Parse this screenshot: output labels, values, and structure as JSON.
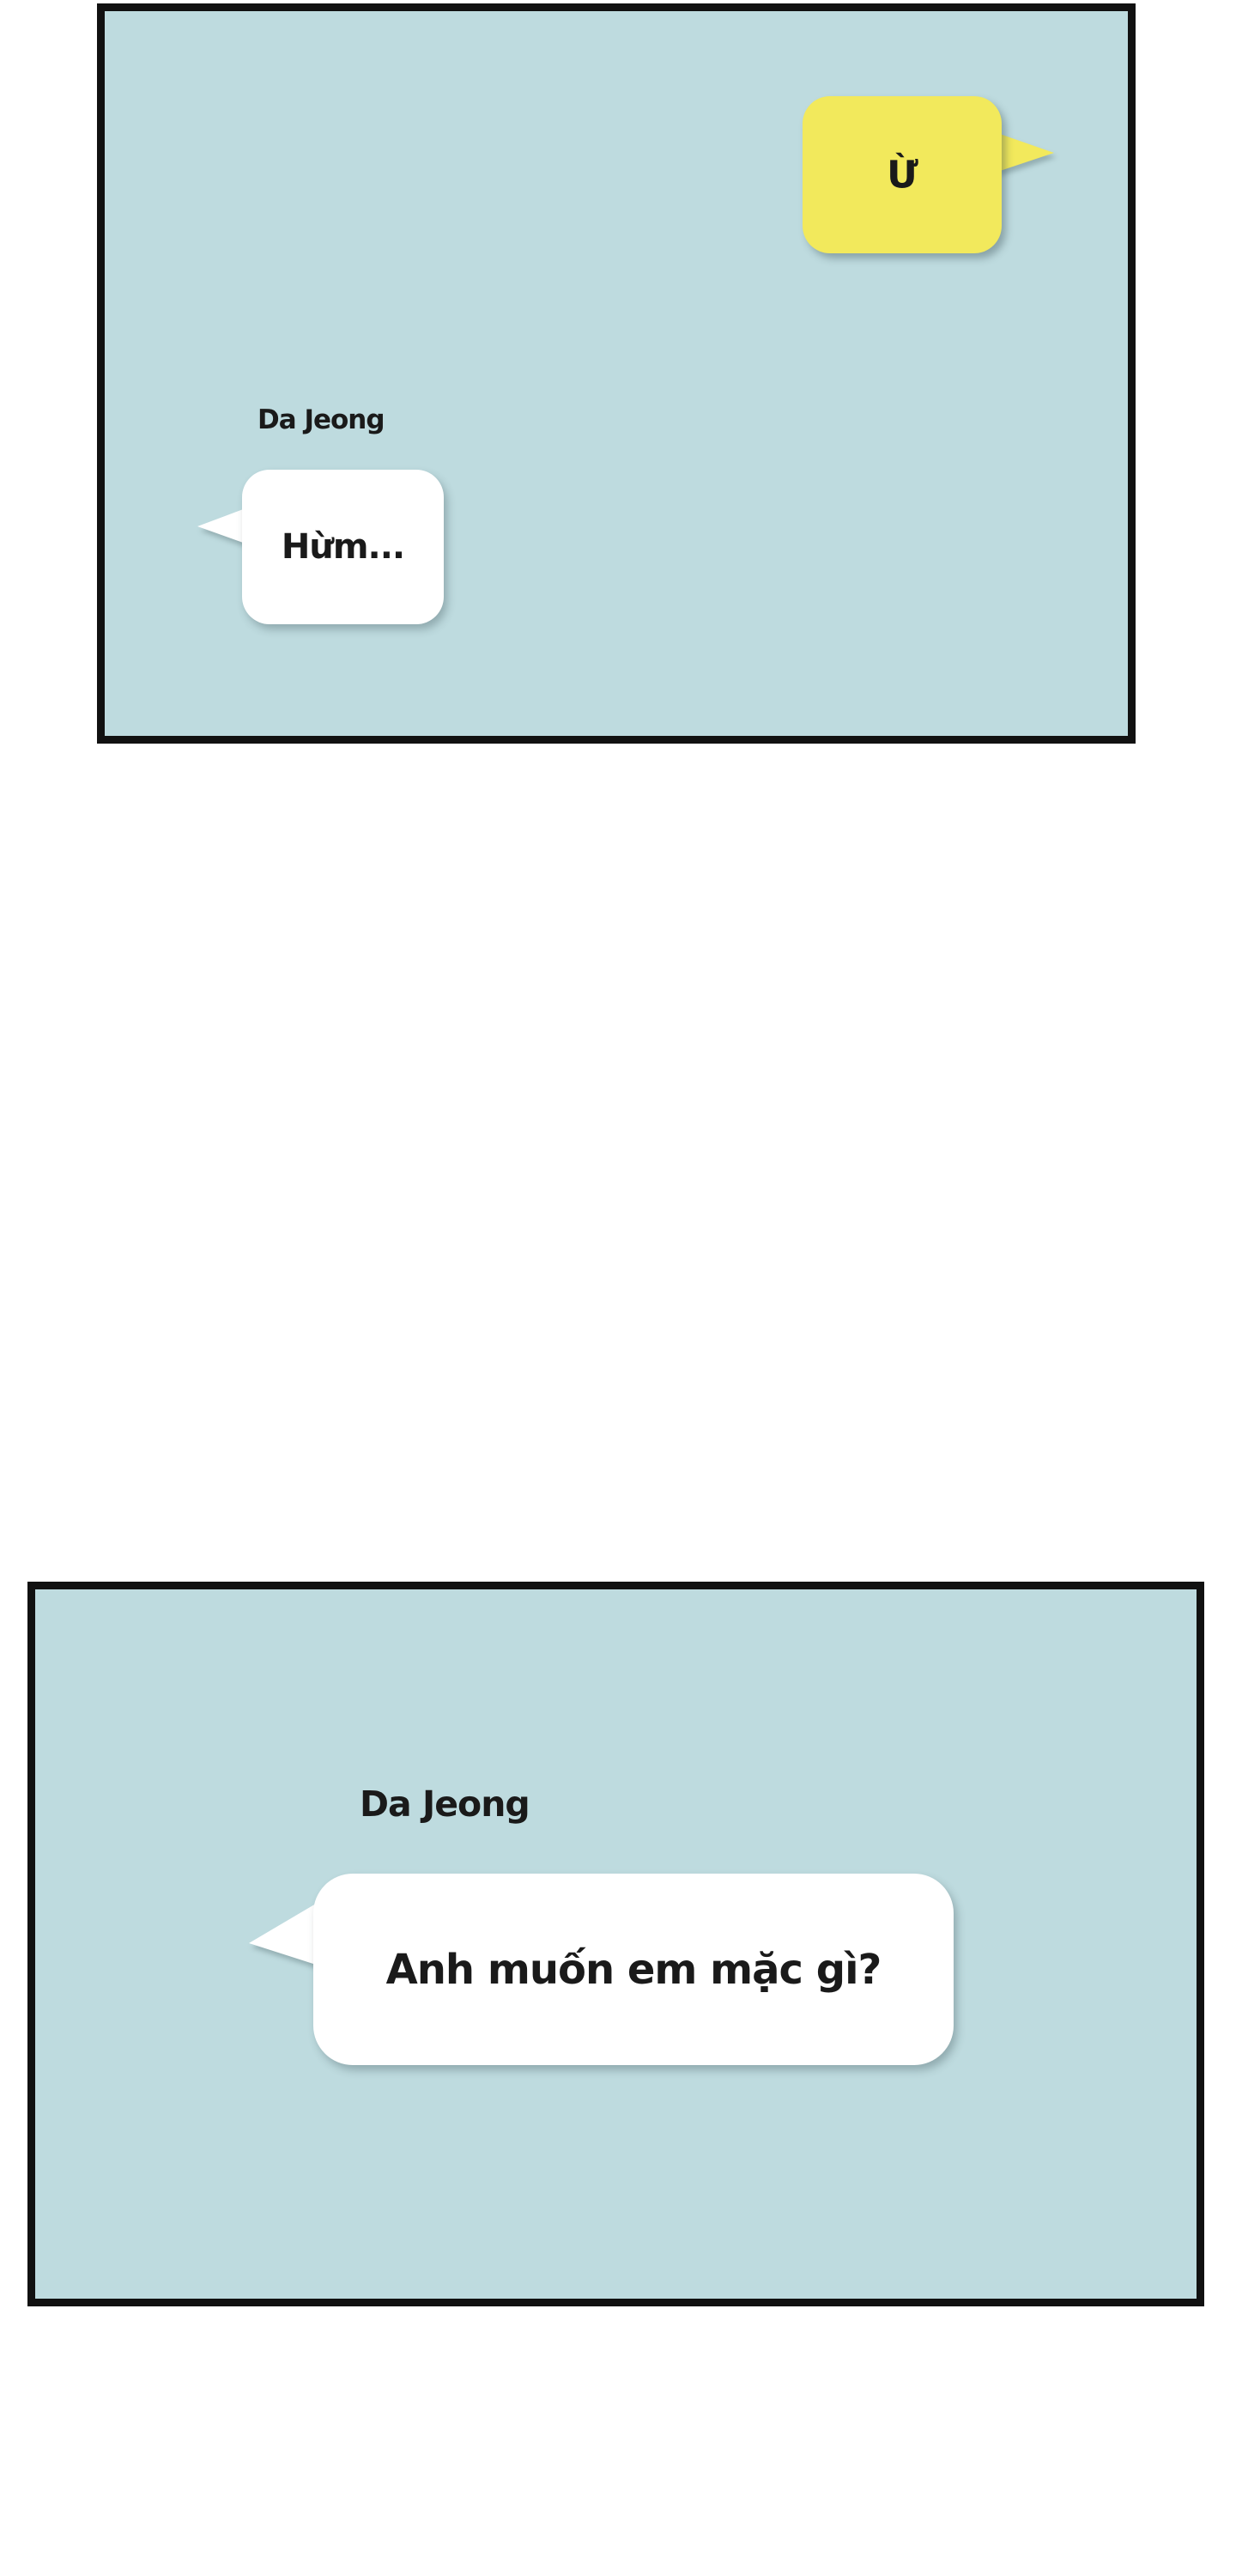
{
  "colors": {
    "page_bg": "#ffffff",
    "panel_bg": "#bedbdf",
    "panel_border": "#111111",
    "bubble_yellow": "#f2e95c",
    "bubble_white": "#ffffff",
    "text": "#1a1a1a"
  },
  "panel1": {
    "yellow_bubble": {
      "text": "Ừ"
    },
    "white_message": {
      "speaker": "Da Jeong",
      "text": "Hừm..."
    }
  },
  "panel2": {
    "white_message": {
      "speaker": "Da Jeong",
      "text": "Anh muốn em mặc gì?"
    }
  }
}
